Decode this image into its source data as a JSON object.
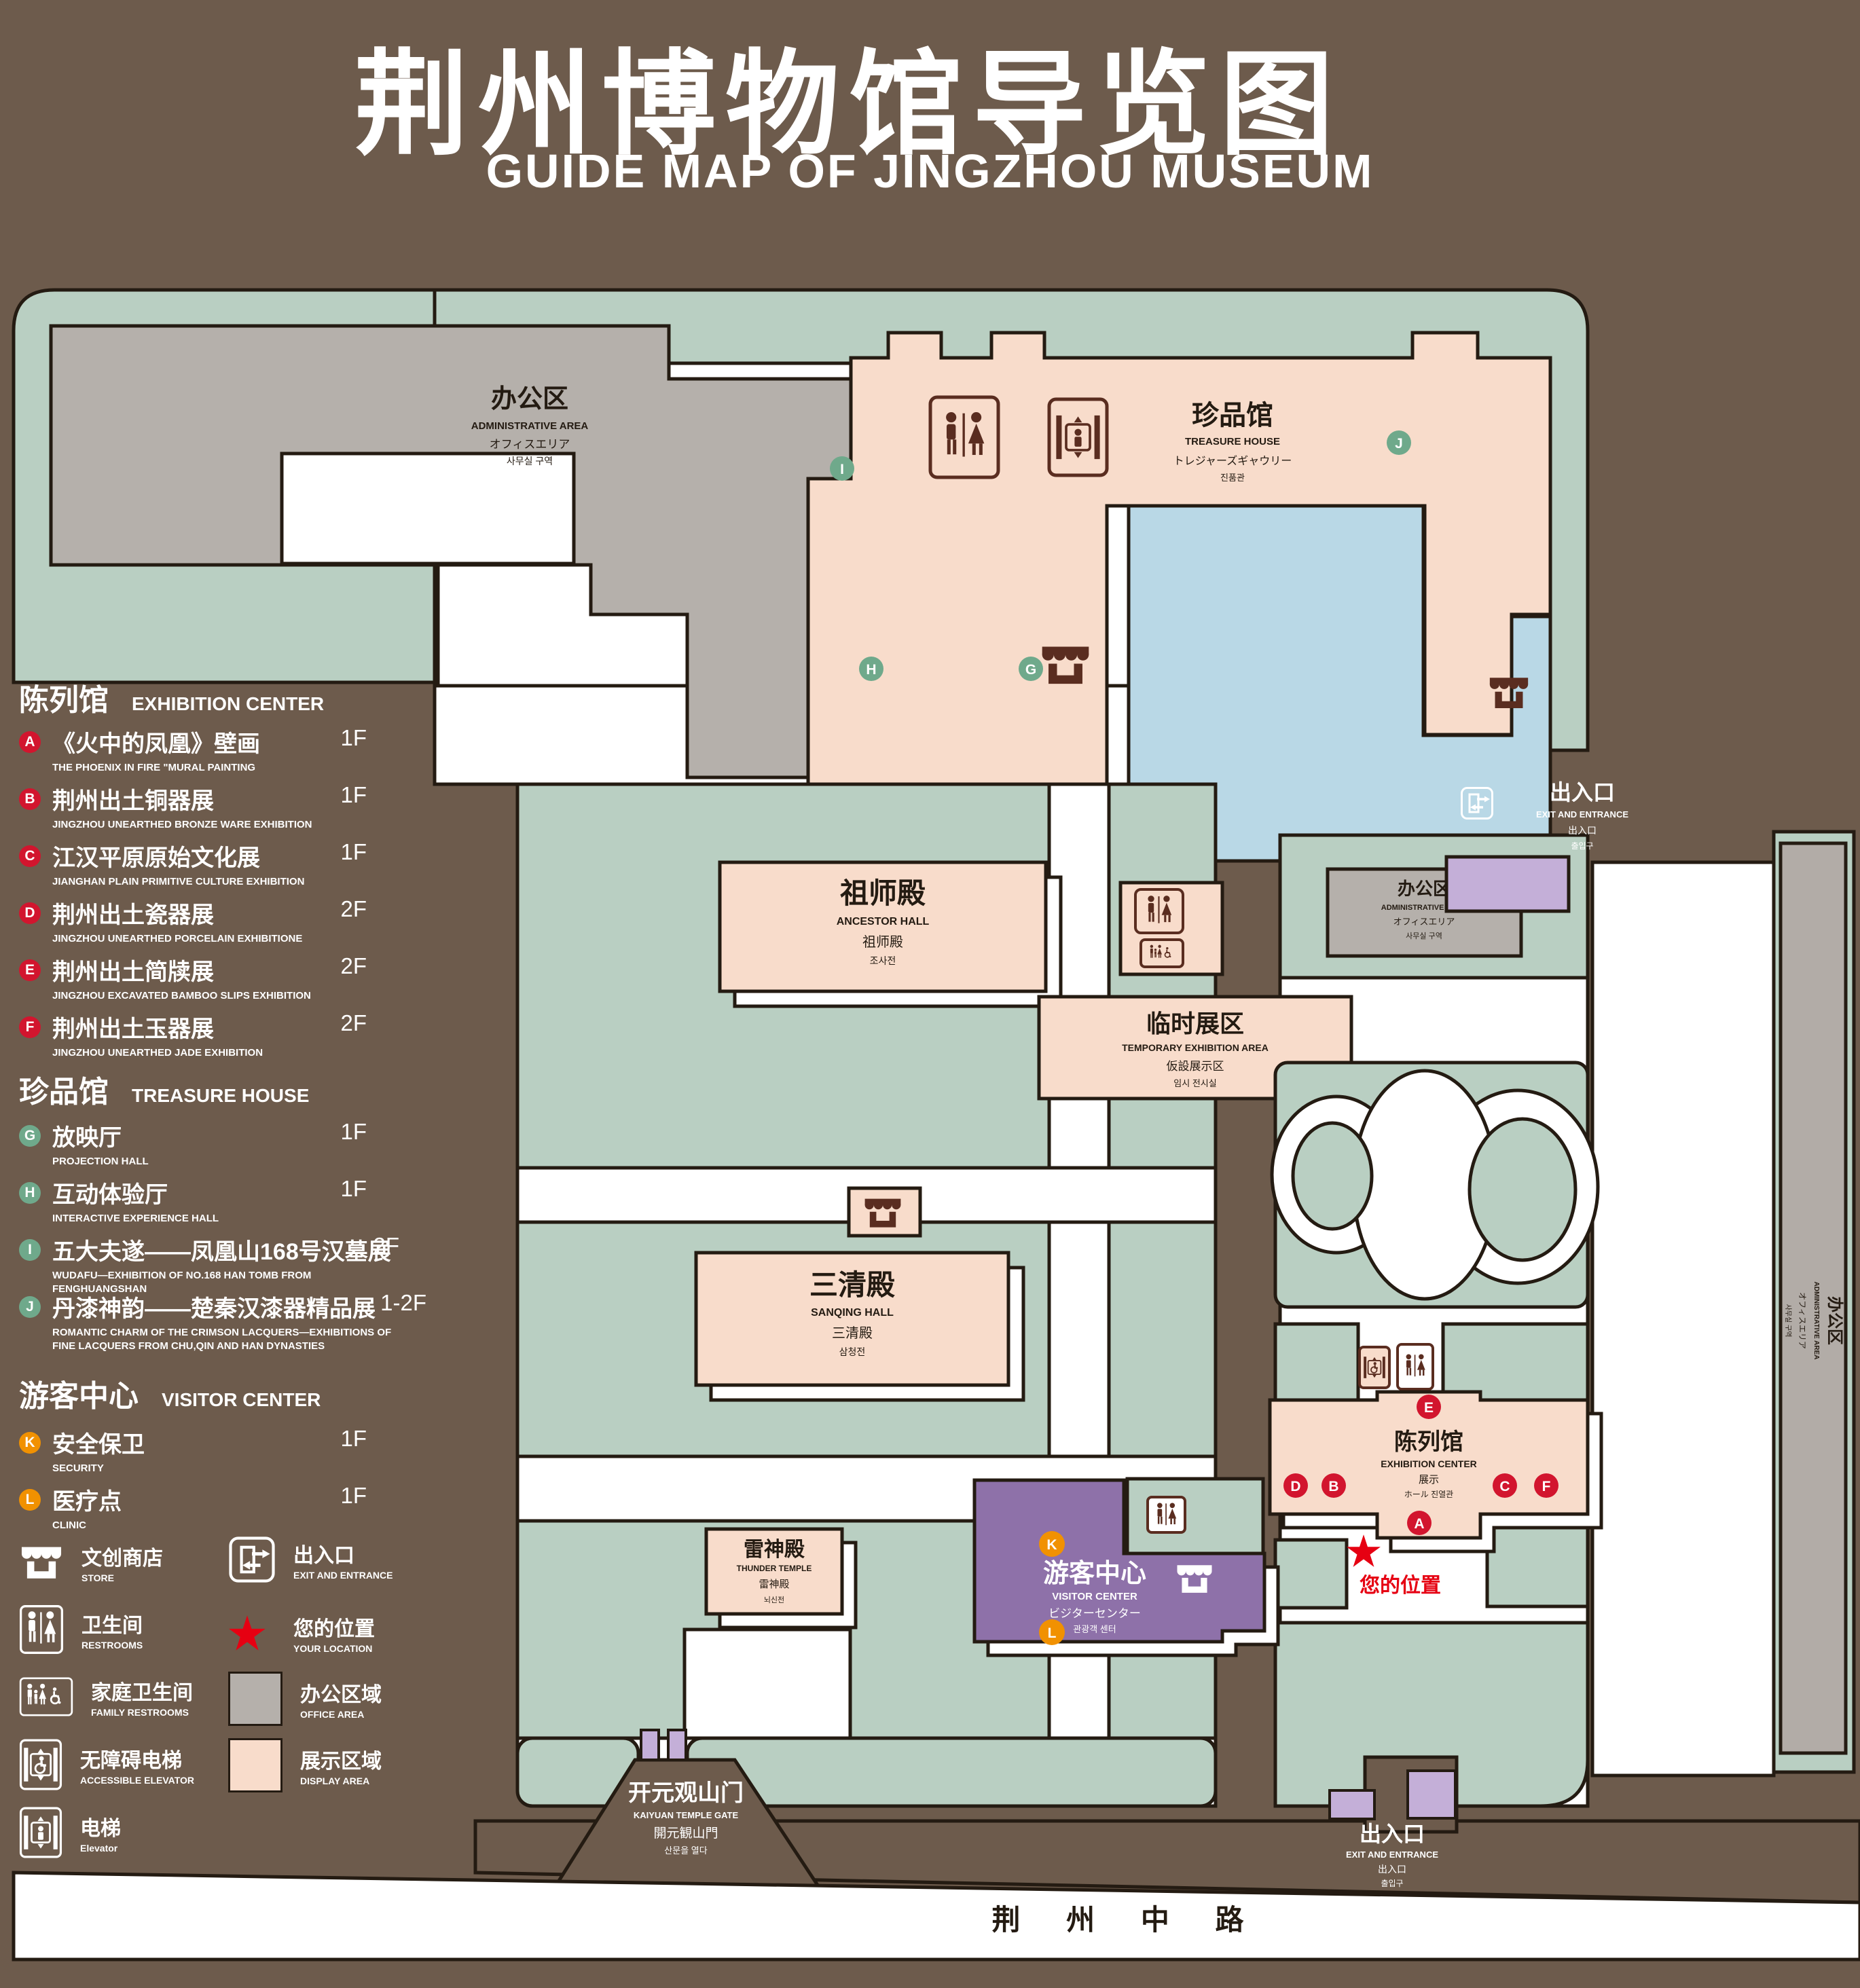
{
  "header": {
    "title_zh": "荆州博物馆导览图",
    "title_en": "GUIDE MAP OF JINGZHOU MUSEUM"
  },
  "colors": {
    "background": "#6d5b4c",
    "lawn": "#b9cfc2",
    "display_area": "#f8dccb",
    "office_area": "#b5b0ab",
    "lake": "#b9d8e6",
    "visitor_center": "#8e71a9",
    "gate_purple": "#c4afd8",
    "badge_red": "#d2152e",
    "badge_green": "#6fa98b",
    "badge_orange": "#f19101",
    "icon_brown": "#5a2d20",
    "location_red": "#e60012"
  },
  "legend": {
    "sections": [
      {
        "title_zh": "陈列馆",
        "title_en": "EXHIBITION CENTER",
        "items": [
          {
            "letter": "A",
            "zh": "《火中的凤凰》壁画",
            "en": "THE PHOENIX IN FIRE \"MURAL PAINTING",
            "floor": "1F"
          },
          {
            "letter": "B",
            "zh": "荆州出土铜器展",
            "en": "JINGZHOU UNEARTHED BRONZE WARE EXHIBITION",
            "floor": "1F"
          },
          {
            "letter": "C",
            "zh": "江汉平原原始文化展",
            "en": "JIANGHAN PLAIN PRIMITIVE CULTURE EXHIBITION",
            "floor": "1F"
          },
          {
            "letter": "D",
            "zh": "荆州出土瓷器展",
            "en": "JINGZHOU UNEARTHED PORCELAIN EXHIBITIONE",
            "floor": "2F"
          },
          {
            "letter": "E",
            "zh": "荆州出土简牍展",
            "en": "JINGZHOU EXCAVATED BAMBOO SLIPS EXHIBITION",
            "floor": "2F"
          },
          {
            "letter": "F",
            "zh": "荆州出土玉器展",
            "en": "JINGZHOU UNEARTHED JADE EXHIBITION",
            "floor": "2F"
          }
        ]
      },
      {
        "title_zh": "珍品馆",
        "title_en": "TREASURE HOUSE",
        "items": [
          {
            "letter": "G",
            "zh": "放映厅",
            "en": "PROJECTION HALL",
            "floor": "1F"
          },
          {
            "letter": "H",
            "zh": "互动体验厅",
            "en": "INTERACTIVE EXPERIENCE HALL",
            "floor": "1F"
          },
          {
            "letter": "I",
            "zh": "五大夫遂——凤凰山168号汉墓展",
            "en": "WUDAFU—EXHIBITION OF NO.168 HAN TOMB FROM FENGHUANGSHAN",
            "floor": "2F"
          },
          {
            "letter": "J",
            "zh": "丹漆神韵——楚秦汉漆器精品展",
            "en": "ROMANTIC CHARM OF THE CRIMSON LACQUERS—EXHIBITIONS OF FINE LACQUERS FROM CHU,QIN AND HAN DYNASTIES",
            "floor": "1-2F"
          }
        ]
      },
      {
        "title_zh": "游客中心",
        "title_en": "VISITOR CENTER",
        "items": [
          {
            "letter": "K",
            "zh": "安全保卫",
            "en": "SECURITY",
            "floor": "1F"
          },
          {
            "letter": "L",
            "zh": "医疗点",
            "en": "CLINIC",
            "floor": "1F"
          }
        ]
      }
    ],
    "symbols": [
      {
        "name": "store",
        "zh": "文创商店",
        "en": "STORE"
      },
      {
        "name": "exit",
        "zh": "出入口",
        "en": "EXIT AND ENTRANCE"
      },
      {
        "name": "restrooms",
        "zh": "卫生间",
        "en": "RESTROOMS"
      },
      {
        "name": "your-location",
        "zh": "您的位置",
        "en": "YOUR LOCATION"
      },
      {
        "name": "family-restrooms",
        "zh": "家庭卫生间",
        "en": "FAMILY RESTROOMS"
      },
      {
        "name": "office-area",
        "zh": "办公区域",
        "en": "OFFICE AREA"
      },
      {
        "name": "accessible-elevator",
        "zh": "无障碍电梯",
        "en": "ACCESSIBLE ELEVATOR"
      },
      {
        "name": "display-area",
        "zh": "展示区域",
        "en": "DISPLAY AREA"
      },
      {
        "name": "elevator",
        "zh": "电梯",
        "en": "Elevator"
      }
    ]
  },
  "map": {
    "buildings": {
      "admin_area": {
        "zh": "办公区",
        "en": "ADMINISTRATIVE AREA",
        "ja": "オフィスエリア",
        "ko": "사무실 구역"
      },
      "treasure_house": {
        "zh": "珍品馆",
        "en": "TREASURE HOUSE",
        "ja": "トレジャーズギャウリー",
        "ko": "진품관"
      },
      "ancestor_hall": {
        "zh": "祖师殿",
        "en": "ANCESTOR HALL",
        "ja": "祖师殿",
        "ko": "조사전"
      },
      "temporary_exhibition": {
        "zh": "临时展区",
        "en": "TEMPORARY EXHIBITION AREA",
        "ja": "仮設展示区",
        "ko": "임시 전시실"
      },
      "sanqing_hall": {
        "zh": "三清殿",
        "en": "SANQING HALL",
        "ja": "三清殿",
        "ko": "삼청전"
      },
      "thunder_temple": {
        "zh": "雷神殿",
        "en": "THUNDER TEMPLE",
        "ja": "雷神殿",
        "ko": "뇌신전"
      },
      "visitor_center": {
        "zh": "游客中心",
        "en": "VISITOR CENTER",
        "ja": "ビジターセンター",
        "ko": "관광객 센터"
      },
      "exhibition_center": {
        "zh": "陈列馆",
        "en": "EXHIBITION CENTER",
        "ja": "展示",
        "ko": "ホール 진열관"
      }
    },
    "gates": {
      "exit": {
        "zh": "出入口",
        "en": "EXIT AND ENTRANCE",
        "ja": "出入口",
        "ko": "출입구"
      },
      "kaiyuan": {
        "zh": "开元观山门",
        "en": "KAIYUAN TEMPLE GATE",
        "ja": "開元観山門",
        "ko": "산문을 열다"
      }
    },
    "road": {
      "name": "荆 州 中 路"
    },
    "your_location": {
      "label": "您的位置"
    },
    "badges": {
      "a": "A",
      "b": "B",
      "c": "C",
      "d": "D",
      "e": "E",
      "f": "F",
      "g": "G",
      "h": "H",
      "i": "I",
      "j": "J",
      "k": "K",
      "l": "L"
    }
  }
}
